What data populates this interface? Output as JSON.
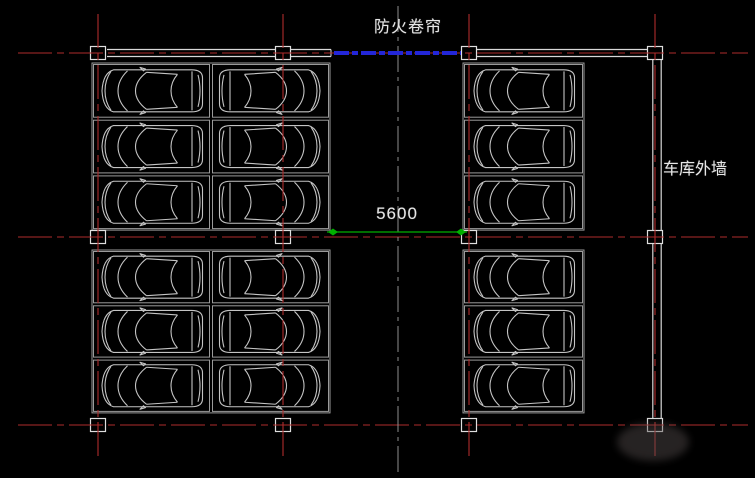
{
  "drawing": {
    "type": "garage-parking-floor-plan",
    "width": 755,
    "height": 478,
    "background": "#000000"
  },
  "labels": {
    "fire_shutter": "防火卷帘",
    "outer_wall": "车库外墙",
    "dimension_value": "5600"
  },
  "colors": {
    "axis_red": "#ae2b2b",
    "wall_white": "#d8d8d8",
    "stall_gray": "#9a9a9a",
    "car_gray": "#c4c4c4",
    "marker_white": "#dedede",
    "shutter_blue": "#2326d8",
    "dimension_green": "#00b000",
    "centerline_gray": "#8e8e8e",
    "text_white": "#e6e6e6"
  },
  "grid": {
    "vertical_x": [
      98,
      283,
      469,
      655
    ],
    "vertical_y1": 14,
    "vertical_y2": 460,
    "horizontal_y": [
      53,
      237,
      425
    ],
    "horizontal_x1": 18,
    "horizontal_x2": 748,
    "marker_w": 15,
    "marker_h": 13
  },
  "walls": {
    "top_y": 53,
    "half_gap": 3.5,
    "top_segments": [
      [
        107,
        331
      ],
      [
        477,
        649
      ]
    ],
    "right_wall": {
      "x": 657,
      "half_gap": 4.2,
      "y1": 55,
      "y2": 423
    }
  },
  "fire_shutter_line": {
    "x1": 334,
    "x2": 461,
    "y": 53
  },
  "centerline": {
    "x": 398,
    "y1": 6,
    "y2": 477
  },
  "dimension": {
    "x1": 333,
    "x2": 461,
    "y": 232,
    "overhang": 6,
    "diamond_w": 10,
    "diamond_h": 7
  },
  "parking_blocks": [
    {
      "name": "upper-left",
      "x": 92,
      "y": 63,
      "cols": 2,
      "rows": 3,
      "stall_w": 119,
      "stall_h": 55.7,
      "car_dirs": [
        "left",
        "right"
      ]
    },
    {
      "name": "lower-left",
      "x": 92,
      "y": 250,
      "cols": 2,
      "rows": 3,
      "stall_w": 119,
      "stall_h": 54.3,
      "car_dirs": [
        "left",
        "right"
      ]
    },
    {
      "name": "upper-right",
      "x": 463,
      "y": 63,
      "cols": 1,
      "rows": 3,
      "stall_w": 121,
      "stall_h": 55.7,
      "car_dirs": [
        "left"
      ]
    },
    {
      "name": "lower-right",
      "x": 463,
      "y": 250,
      "cols": 1,
      "rows": 3,
      "stall_w": 121,
      "stall_h": 54.3,
      "car_dirs": [
        "left"
      ]
    }
  ],
  "car": {
    "length": 106,
    "width": 44,
    "count": 18
  },
  "watermark": {
    "cx": 653,
    "cy": 442,
    "rx": 36,
    "ry": 19
  }
}
